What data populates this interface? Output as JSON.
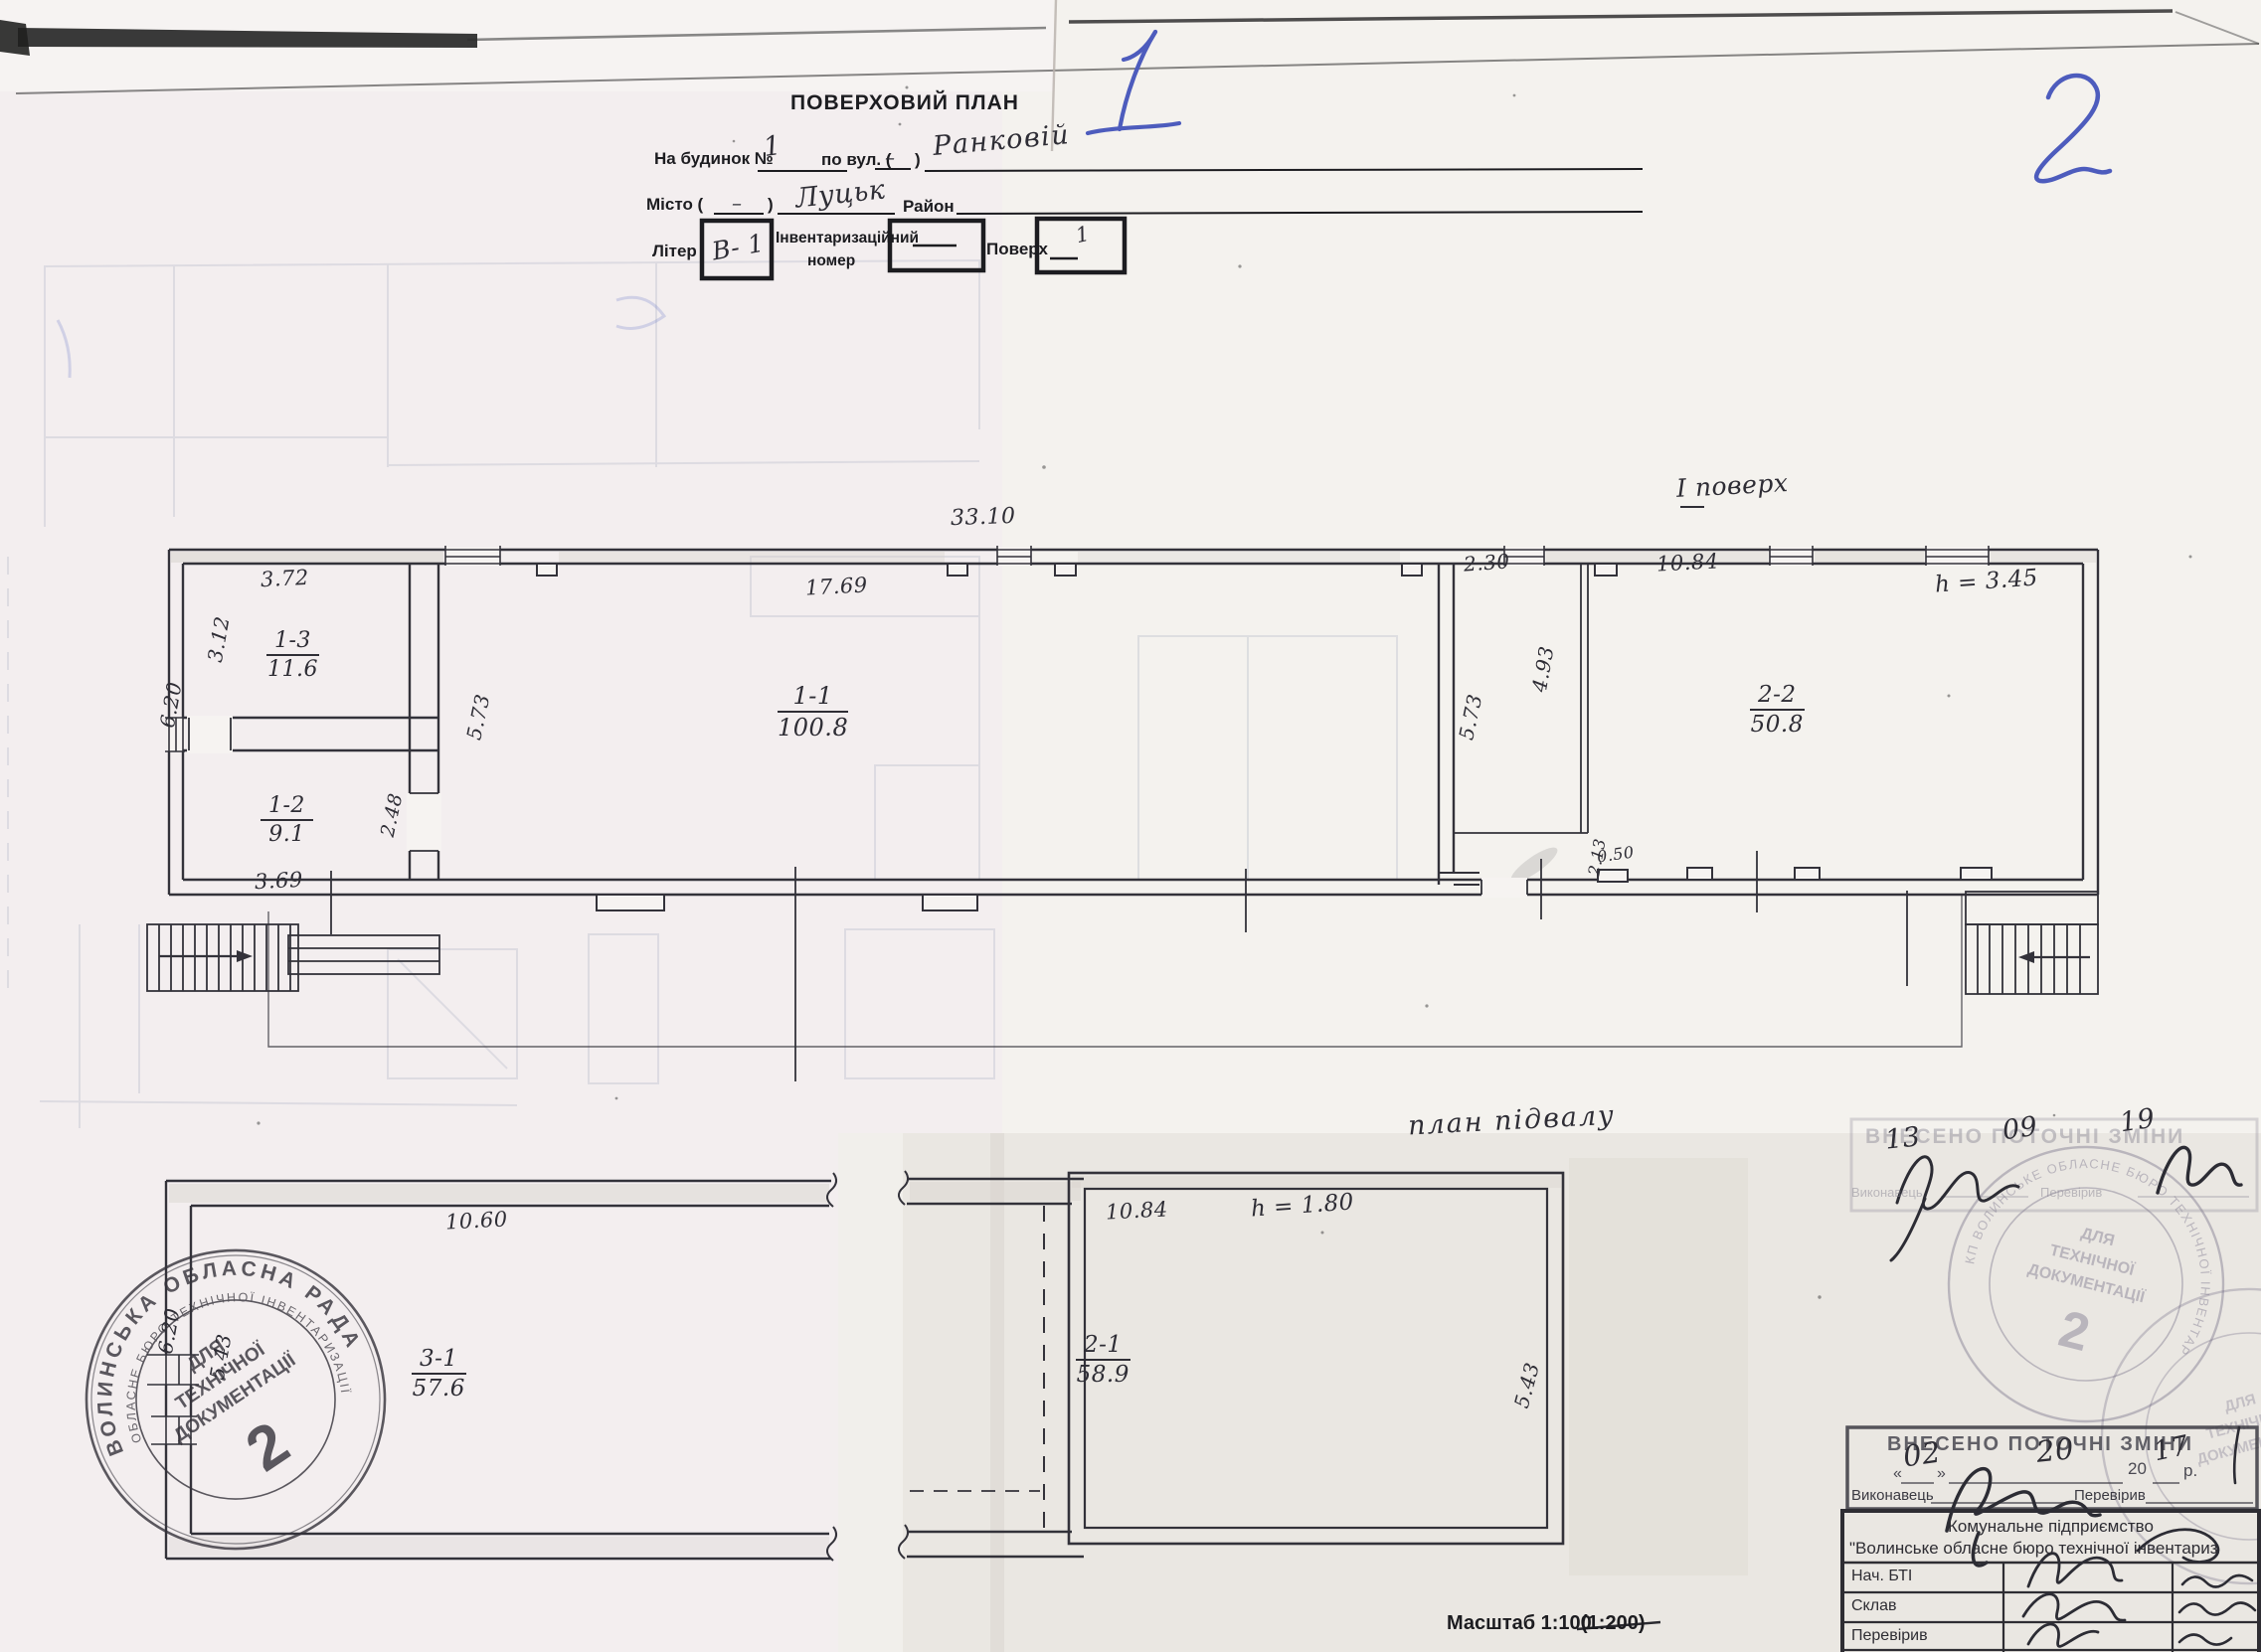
{
  "page": {
    "handwritten_left_page_no": "1",
    "handwritten_right_page_no": "2",
    "title": "ПОВЕРХОВИЙ ПЛАН"
  },
  "form": {
    "building_label": "На будинок №",
    "building_no": "1",
    "street_label": "по вул. (",
    "street_paren_value": "–",
    "paren_close": ")",
    "street_name": "Ранковій",
    "city_label": "Місто (",
    "city_paren_value": "–",
    "city_name": "Луцьк",
    "district_label": "Район",
    "liter_label": "Літер",
    "liter_value": "В- 1",
    "inventory_label_1": "Інвентаризаційний",
    "inventory_label_2": "номер",
    "inventory_value": "—",
    "floor_label": "Поверх",
    "floor_value": "1",
    "floor_dash": "–"
  },
  "floor_plan": {
    "title": "І поверх",
    "height_note": "h = 3.45",
    "rooms": [
      {
        "id": "1-3",
        "area": "11.6"
      },
      {
        "id": "1-2",
        "area": "9.1"
      },
      {
        "id": "1-1",
        "area": "100.8"
      },
      {
        "id": "2-2",
        "area": "50.8"
      }
    ],
    "dims": {
      "overall": "33.10",
      "left_top": "3.72",
      "left_side": "3.12",
      "left_height": "6.20",
      "room12_bottom": "3.69",
      "door": "2.48",
      "hall_left": "5.73",
      "hall_top": "17.69",
      "corr_top": "2.30",
      "corr_len": "4.93",
      "corr_left": "5.73",
      "right_top": "10.84",
      "wall_seg": "2.13",
      "opening": "0.50"
    }
  },
  "basement_plan": {
    "title": "план підвалу",
    "height_note": "h = 1.80",
    "rooms": [
      {
        "id": "3-1",
        "area": "57.6"
      },
      {
        "id": "2-1",
        "area": "58.9"
      }
    ],
    "dims": {
      "left_top": "10.60",
      "left_height": "6.20",
      "left_inner": "5.43",
      "right_top": "10.84",
      "right_side": "5.43"
    }
  },
  "scale_note": {
    "label": "Масштаб 1:100",
    "struck": "(1:200)"
  },
  "stamps": {
    "round_left": {
      "ring_top": "ВОЛИНСЬКА ОБЛАСНА РАДА",
      "ring_inner": "ОБЛАСНЕ БЮРО ТЕХНІЧНОЇ ІНВЕНТАРИЗАЦІЇ",
      "center1": "ДЛЯ",
      "center2": "ТЕХНІЧНОЇ",
      "center3": "ДОКУМЕНТАЦІЇ",
      "number": "2"
    },
    "round_right": {
      "ring": "КП ВОЛИНСЬКЕ ОБЛАСНЕ БЮРО ТЕХНІЧНОЇ ІНВЕНТАРИЗАЦІЇ * УКРАЇНА *",
      "center1": "ДЛЯ",
      "center2": "ТЕХНІЧНОЇ",
      "center3": "ДОКУМЕНТАЦІЇ",
      "number": "2"
    },
    "changes_top": {
      "title": "ВНЕСЕНО ПОТОЧНІ ЗМІНИ",
      "date_d": "13",
      "date_m": "09",
      "date_y": "19",
      "executor_label": "Виконавець",
      "checker_label": "Перевірив"
    },
    "changes_bottom": {
      "title": "ВНЕСЕНО ПОТОЧНІ ЗМІНИ",
      "quote_open": "«",
      "quote_close": "»",
      "date_d": "02",
      "date_m": "20",
      "year_prefix": "20",
      "date_y": "17",
      "year_suffix": "р.",
      "executor_label": "Виконавець",
      "checker_label": "Перевірив"
    }
  },
  "org_table": {
    "header1": "Комунальне підприємство",
    "header2": "\"Волинське обласне бюро технічної інвентариз",
    "rows": [
      {
        "label": "Нач. БТІ"
      },
      {
        "label": "Склав"
      },
      {
        "label": "Перевірив"
      }
    ]
  }
}
